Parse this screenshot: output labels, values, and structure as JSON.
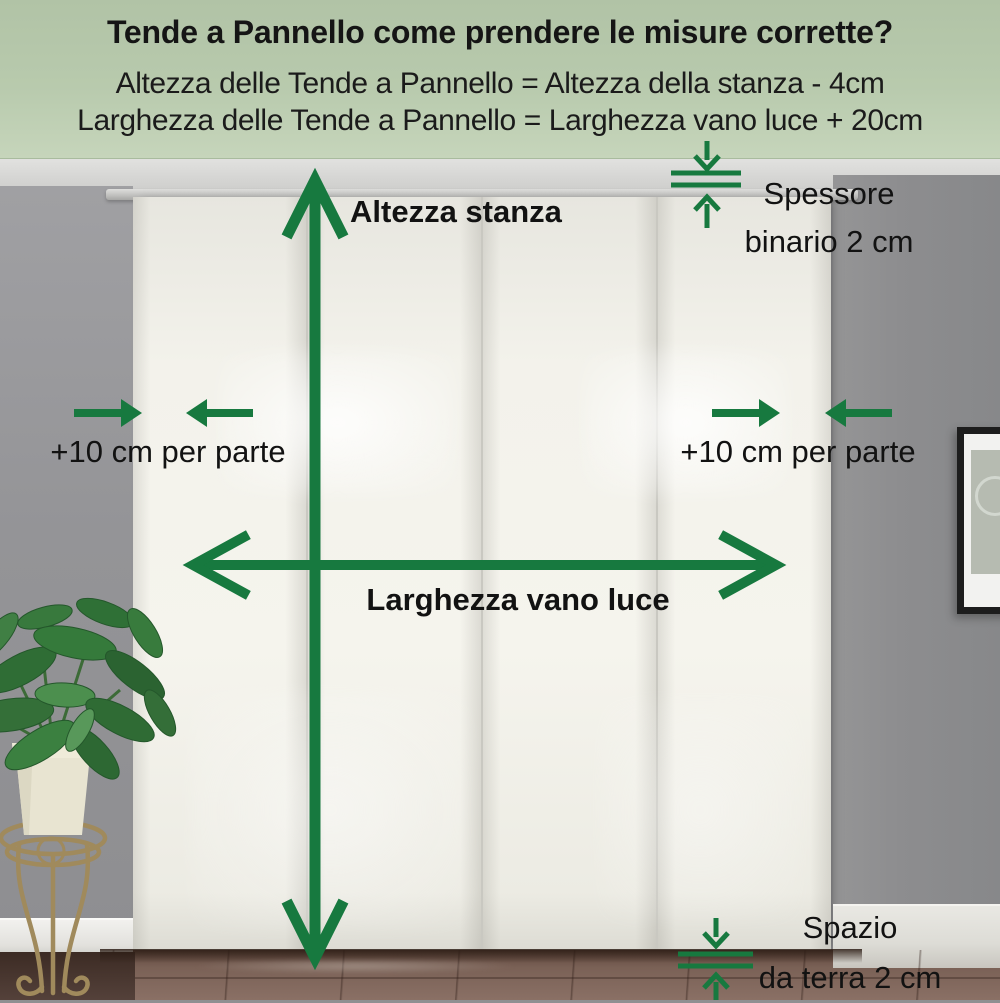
{
  "header": {
    "title": "Tende a Pannello come prendere le misure corrette?",
    "formula_height": "Altezza delle Tende a Pannello = Altezza della stanza - 4cm",
    "formula_width": "Larghezza delle Tende a Pannello = Larghezza vano luce + 20cm"
  },
  "annotations": {
    "room_height": {
      "label": "Altezza stanza"
    },
    "opening_width": {
      "label": "Larghezza vano luce"
    },
    "margin_left": {
      "label": "+10 cm per parte"
    },
    "margin_right": {
      "label": "+10 cm per parte"
    },
    "rail_thickness": {
      "line1": "Spessore",
      "line2": "binario 2 cm"
    },
    "floor_gap": {
      "line1": "Spazio",
      "line2": "da terra 2 cm"
    }
  },
  "colors": {
    "arrow_green": "#17793f",
    "header_background": "#b7c9ac",
    "text_black": "#151515",
    "curtain_white": "#f3f2eb",
    "wall_gray": "#8f8f91",
    "floor_brown": "#7a6156"
  }
}
